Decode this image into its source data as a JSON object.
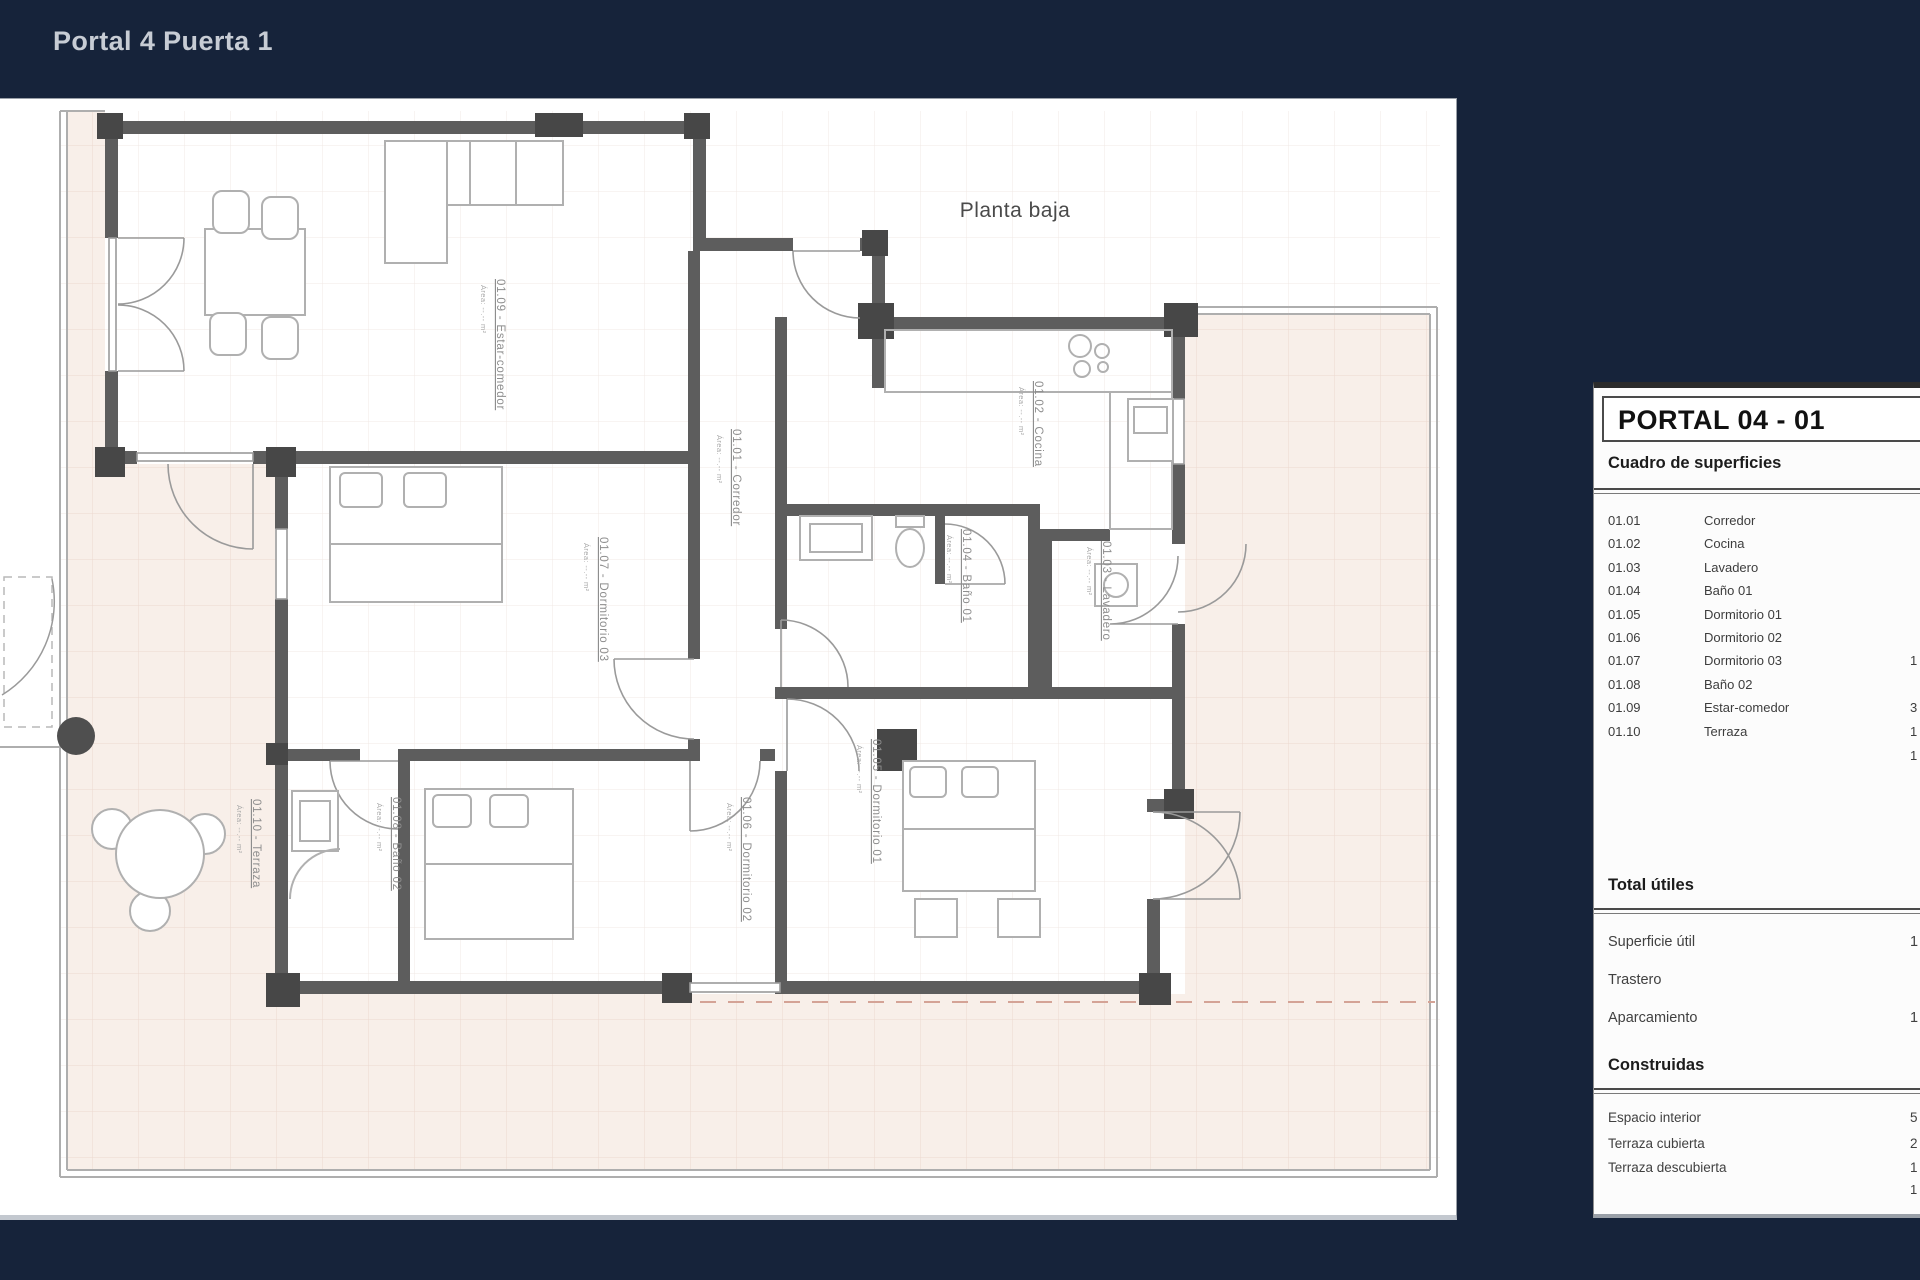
{
  "page": {
    "title": "Portal 4 Puerta 1",
    "background_color": "#16233a",
    "accent_text_color": "#c7ccd4"
  },
  "plan": {
    "caption": "Planta baja",
    "room_labels": [
      {
        "text": "01.09 - Estar-comedor",
        "area": "Área: --.-- m²"
      },
      {
        "text": "01.01 - Corredor",
        "area": "Área: --.-- m²"
      },
      {
        "text": "01.02 - Cocina",
        "area": "Área: --.-- m²"
      },
      {
        "text": "01.03 - Lavadero",
        "area": "Área: --.-- m²"
      },
      {
        "text": "01.04 - Baño 01",
        "area": "Área: --.-- m²"
      },
      {
        "text": "01.07 - Dormitorio 03",
        "area": "Área: --.-- m²"
      },
      {
        "text": "01.06 - Dormitorio 02",
        "area": "Área: --.-- m²"
      },
      {
        "text": "01.05 - Dormitorio 01",
        "area": "Área: --.-- m²"
      },
      {
        "text": "01.08 - Baño 02",
        "area": "Área: --.-- m²"
      },
      {
        "text": "01.10 - Terraza",
        "area": "Área: --.-- m²"
      }
    ]
  },
  "surfaces_panel": {
    "title": "PORTAL 04 - 01",
    "subtitle": "Cuadro de superficies",
    "rows": [
      {
        "code": "01.01",
        "name": "Corredor",
        "value": ""
      },
      {
        "code": "01.02",
        "name": "Cocina",
        "value": ""
      },
      {
        "code": "01.03",
        "name": "Lavadero",
        "value": ""
      },
      {
        "code": "01.04",
        "name": "Baño 01",
        "value": ""
      },
      {
        "code": "01.05",
        "name": "Dormitorio 01",
        "value": ""
      },
      {
        "code": "01.06",
        "name": "Dormitorio 02",
        "value": ""
      },
      {
        "code": "01.07",
        "name": "Dormitorio 03",
        "value": "1"
      },
      {
        "code": "01.08",
        "name": "Baño 02",
        "value": ""
      },
      {
        "code": "01.09",
        "name": "Estar-comedor",
        "value": "3"
      },
      {
        "code": "01.10",
        "name": "Terraza",
        "value": "1"
      }
    ],
    "rooms_total_partial": "1",
    "total_utiles_label": "Total útiles",
    "superficie_util": {
      "label": "Superficie útil",
      "value": "1"
    },
    "trastero": {
      "label": "Trastero",
      "value": ""
    },
    "aparcamiento": {
      "label": "Aparcamiento",
      "value": "1"
    },
    "construidas_label": "Construidas",
    "espacio_interior": {
      "label": "Espacio interior",
      "value": "5"
    },
    "terraza_cubierta": {
      "label": "Terraza cubierta",
      "value": "2"
    },
    "terraza_descubierta": {
      "label": "Terraza descubierta",
      "value": "1"
    },
    "construidas_total_partial": "1"
  }
}
